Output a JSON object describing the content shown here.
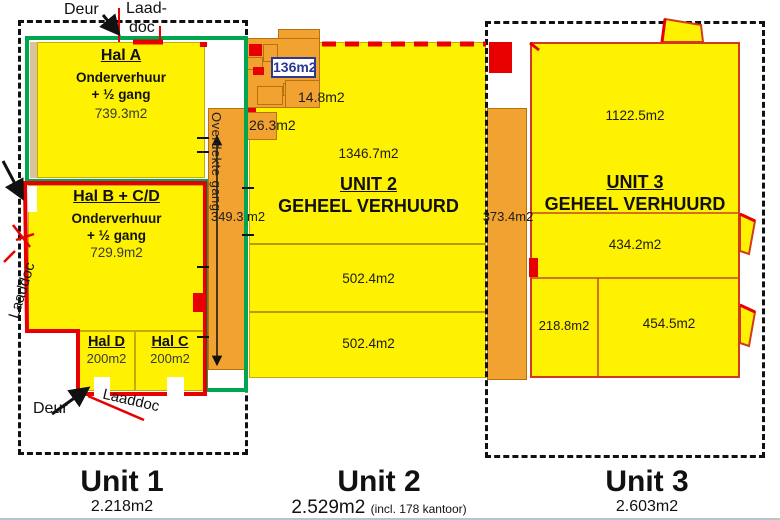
{
  "footer": {
    "units": [
      {
        "name": "Unit 1",
        "area": "2.218m2",
        "note": ""
      },
      {
        "name": "Unit 2",
        "area": "2.529m2",
        "note": "(incl. 178 kantoor)"
      },
      {
        "name": "Unit 3",
        "area": "2.603m2",
        "note": ""
      }
    ]
  },
  "unit1": {
    "annotations": {
      "deur_top": "Deur",
      "laaddoc_top_line1": "Laad-",
      "laaddoc_top_line2": "doc",
      "laaddoc_left": "Laaddoc",
      "deur_bottom": "Deur",
      "laaddoc_bottom": "Laaddoc"
    },
    "hal_a": {
      "name": "Hal A",
      "line1": "Onderverhuur",
      "line2": "+ ½ gang",
      "area": "739.3m2"
    },
    "hal_bcd": {
      "name": "Hal B + C/D",
      "line1": "Onderverhuur",
      "line2": "+ ½ gang",
      "area": "729.9m2"
    },
    "hal_d": {
      "name": "Hal D",
      "area": "200m2"
    },
    "hal_c": {
      "name": "Hal C",
      "area": "200m2"
    },
    "gang": {
      "name": "Overdekte gang",
      "area": "349.3 m2"
    }
  },
  "unit2": {
    "label": "UNIT 2",
    "status": "GEHEEL VERHUURD",
    "office": {
      "room_large": "136m2",
      "room_small": "14.8m2",
      "room_front": "26.3m2"
    },
    "sections": {
      "top": "1346.7m2",
      "mid": "502.4m2",
      "bottom": "502.4m2"
    },
    "corridor_area": "373.4m2"
  },
  "unit3": {
    "label": "UNIT 3",
    "status": "GEHEEL VERHUURD",
    "sections": {
      "main": "1122.5m2",
      "mid": "434.2m2",
      "bottom_left": "218.8m2",
      "bottom_right": "454.5m2"
    }
  },
  "colors": {
    "hall_yellow": "#FFF200",
    "corridor_orange": "#F2A230",
    "outline_green": "#00A550",
    "outline_red": "#E80000",
    "unit3_border": "#D23A1E",
    "office_label_blue": "#2B3990"
  }
}
